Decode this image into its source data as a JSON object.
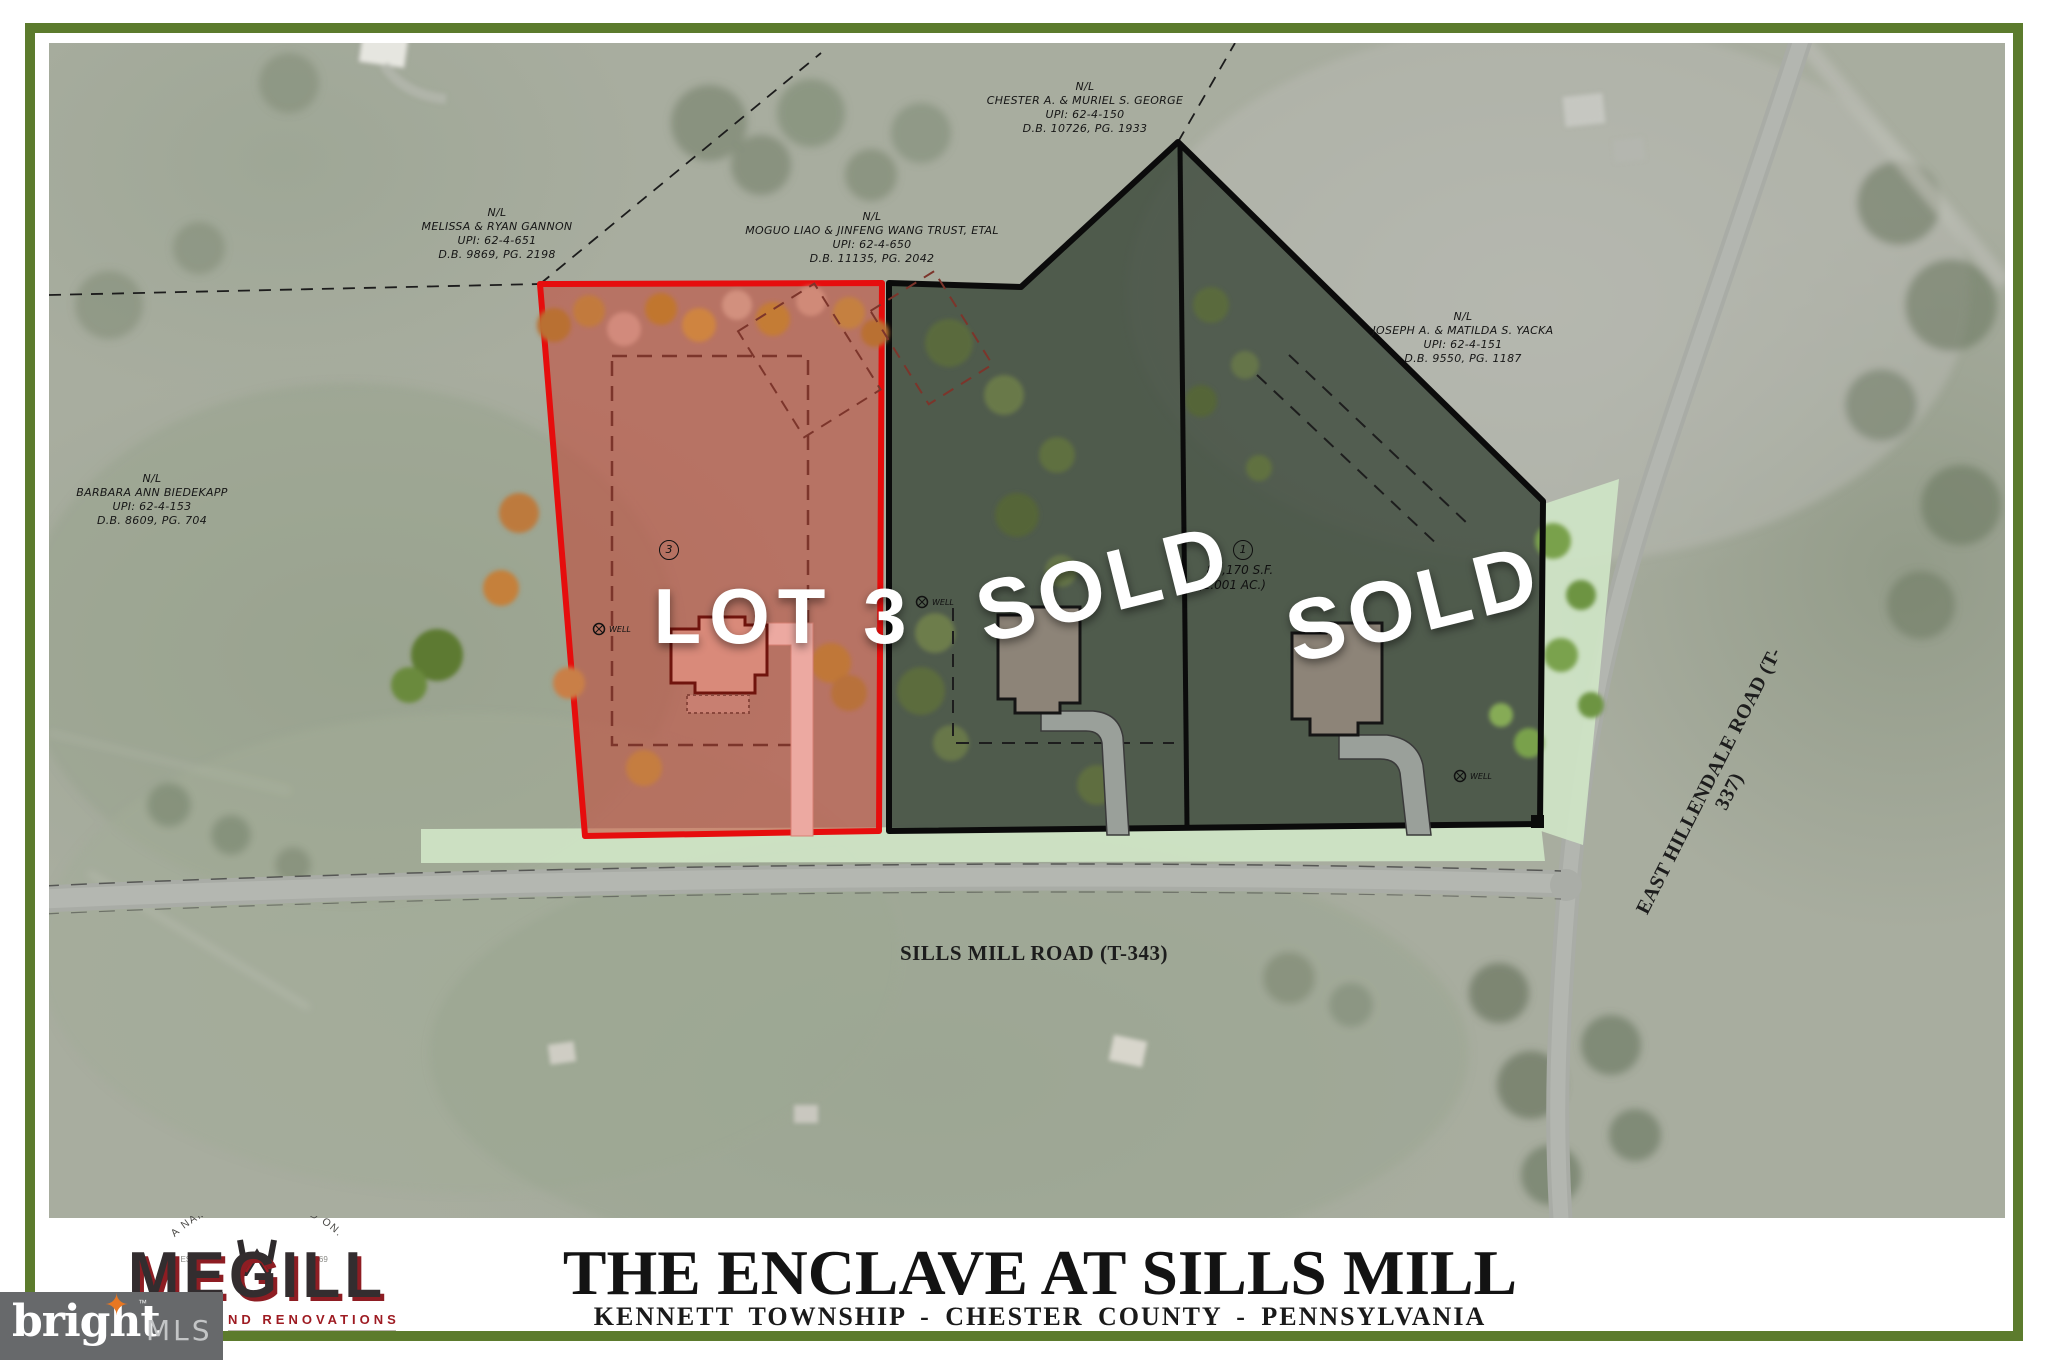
{
  "map": {
    "parcels": [
      {
        "nl": "N/L",
        "name": "MELISSA & RYAN GANNON",
        "upi": "UPI: 62-4-651",
        "db": "D.B. 9869, PG. 2198"
      },
      {
        "nl": "N/L",
        "name": "MOGUO LIAO & JINFENG WANG TRUST, ETAL",
        "upi": "UPI: 62-4-650",
        "db": "D.B. 11135, PG. 2042"
      },
      {
        "nl": "N/L",
        "name": "CHESTER A. & MURIEL S. GEORGE",
        "upi": "UPI: 62-4-150",
        "db": "D.B. 10726, PG. 1933"
      },
      {
        "nl": "N/L",
        "name": "JOSEPH A. & MATILDA S. YACKA",
        "upi": "UPI: 62-4-151",
        "db": "D.B. 9550, PG. 1187"
      },
      {
        "nl": "N/L",
        "name": "BARBARA ANN BIEDEKAPP",
        "upi": "UPI: 62-4-153",
        "db": "D.B. 8609, PG. 704"
      }
    ],
    "lots": {
      "lot3_label": "LOT 3",
      "sold_label": "SOLD",
      "lot1_marker": "1",
      "lot3_marker": "3",
      "lot1_area_sf": "87,170 S.F.",
      "lot1_area_ac": "(2.001 AC.)",
      "lot3_fill": "#c73e2f",
      "lot3_stroke": "#e60d0d",
      "sold_fill": "#2a372a",
      "sold_stroke": "#0b0b0b"
    },
    "roads": {
      "sills_mill": "SILLS MILL ROAD (T-343)",
      "east_hillendale": "EAST HILLENDALE ROAD (T-337)"
    },
    "well_label": "WELL"
  },
  "banner": {
    "title": "THE ENCLAVE AT SILLS MILL",
    "subtitle": "KENNETT TOWNSHIP - CHESTER COUNTY - PENNSYLVANIA",
    "logo": {
      "arc": "A NAME YOU CAN BUILD ON.",
      "estd": "ESTD.",
      "year": "1969",
      "name": "MEGILL",
      "tagline": "ND RENOVATIONS",
      "accent": "#9e1b22"
    }
  },
  "watermark": {
    "brand": "bright",
    "tm": "™",
    "mls": "MLS",
    "star": "✦",
    "bg": "#67696b",
    "star_color": "#e87722"
  },
  "frame_color": "#5c7b2d"
}
